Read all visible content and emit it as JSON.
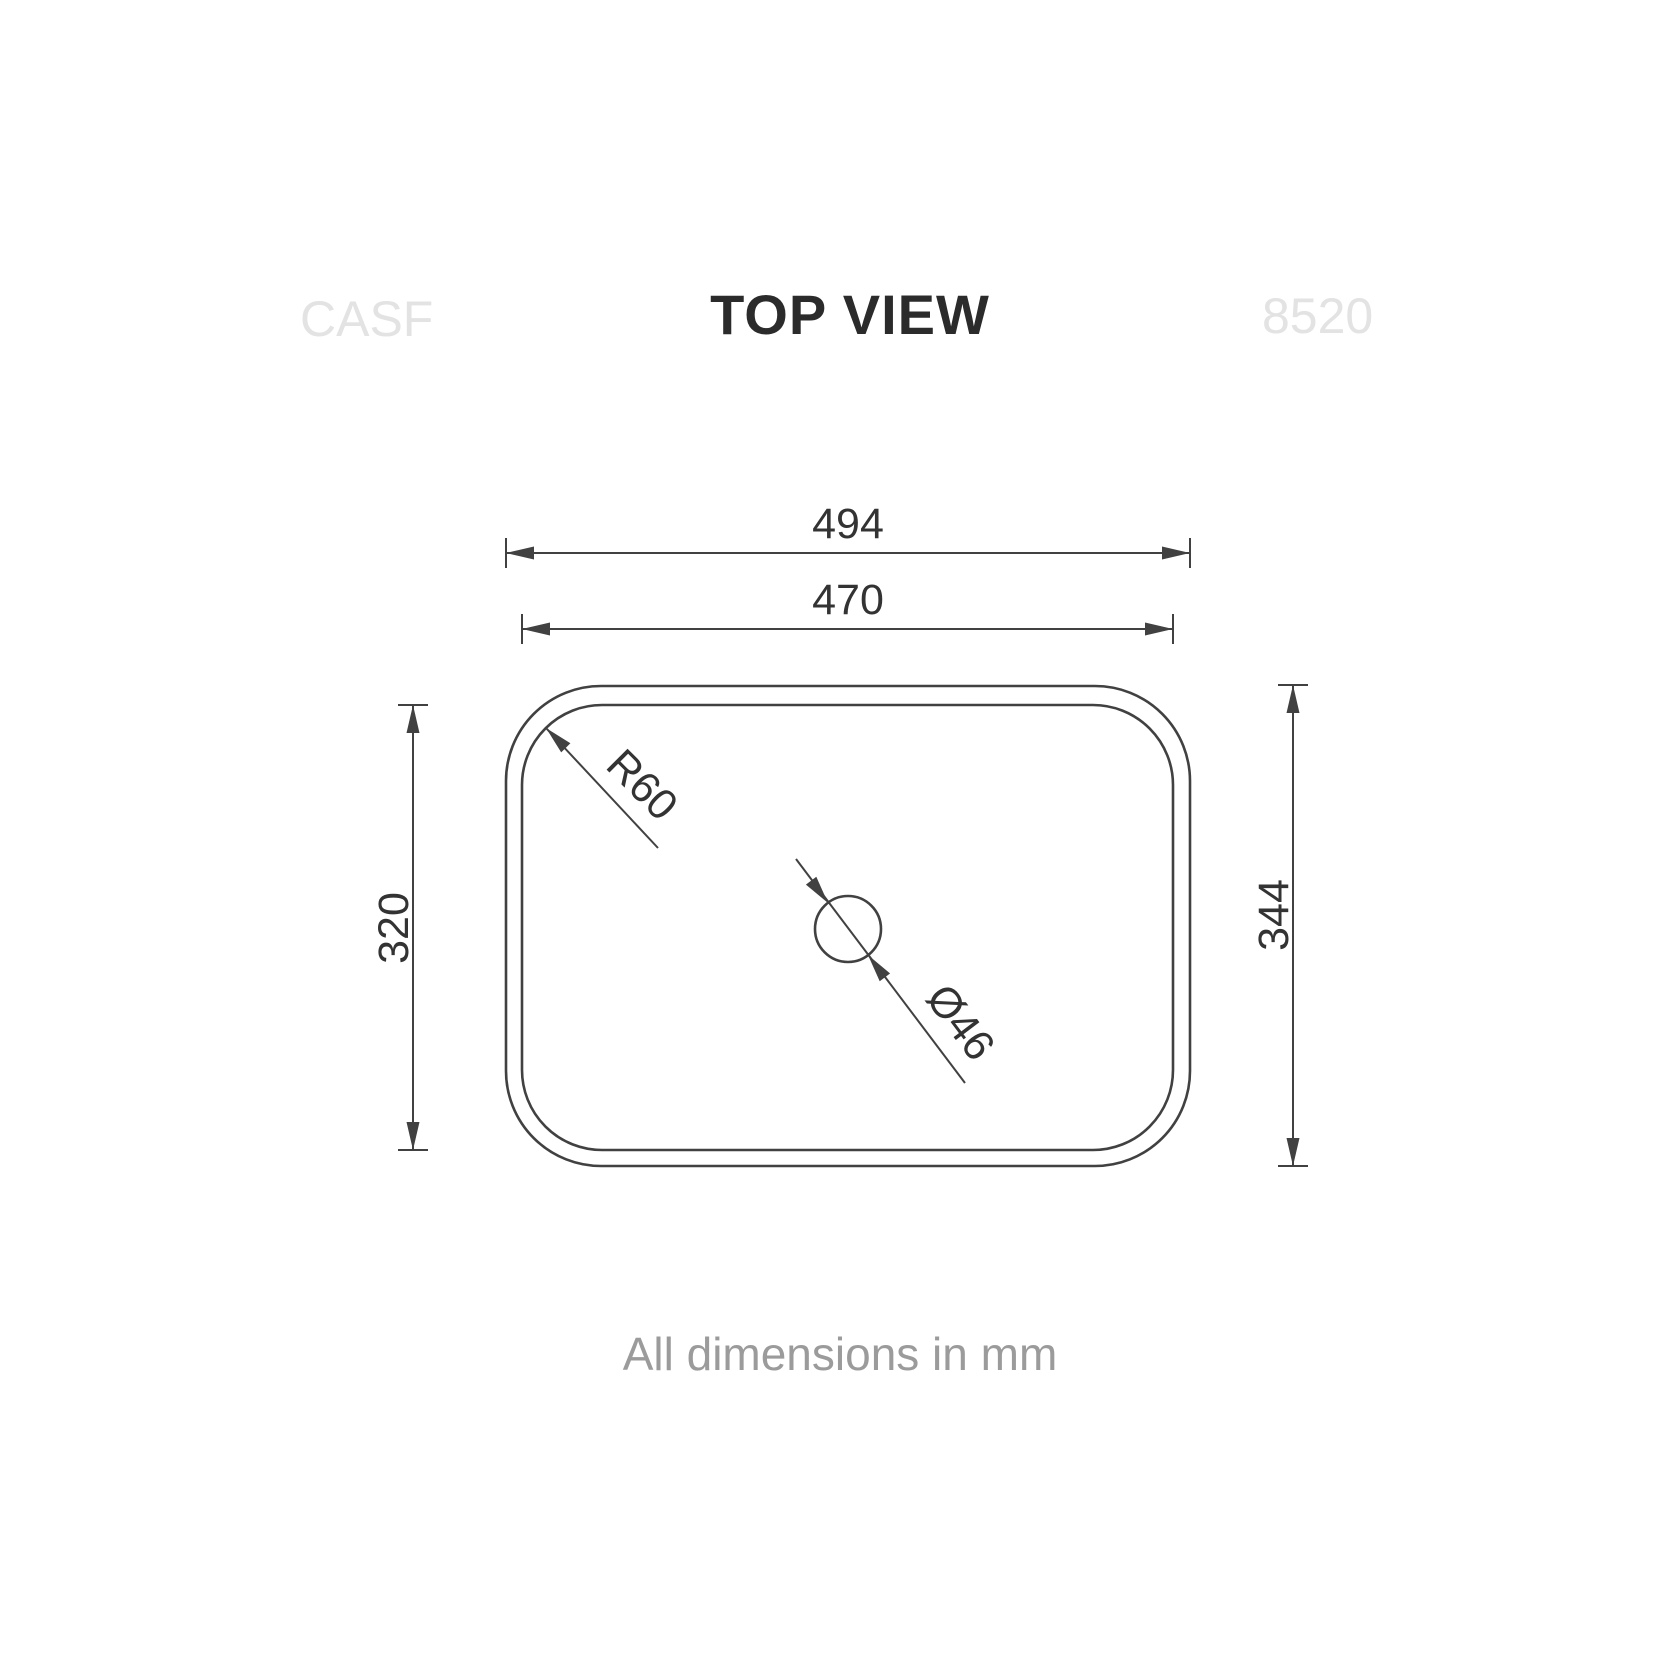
{
  "header": {
    "left_code": "CASF",
    "title": "TOP VIEW",
    "right_code": "8520"
  },
  "dimensions": {
    "outer_width": "494",
    "inner_width": "470",
    "inner_height": "320",
    "outer_height": "344",
    "corner_radius": "R60",
    "drain_diameter": "Ø46"
  },
  "footer": {
    "note": "All dimensions in mm"
  },
  "colors": {
    "background": "#ffffff",
    "line": "#414141",
    "dimension_text": "#333333",
    "title_text": "#2b2b2b",
    "watermark_text": "#e3e3e3",
    "note_text": "#9b9b9b"
  }
}
